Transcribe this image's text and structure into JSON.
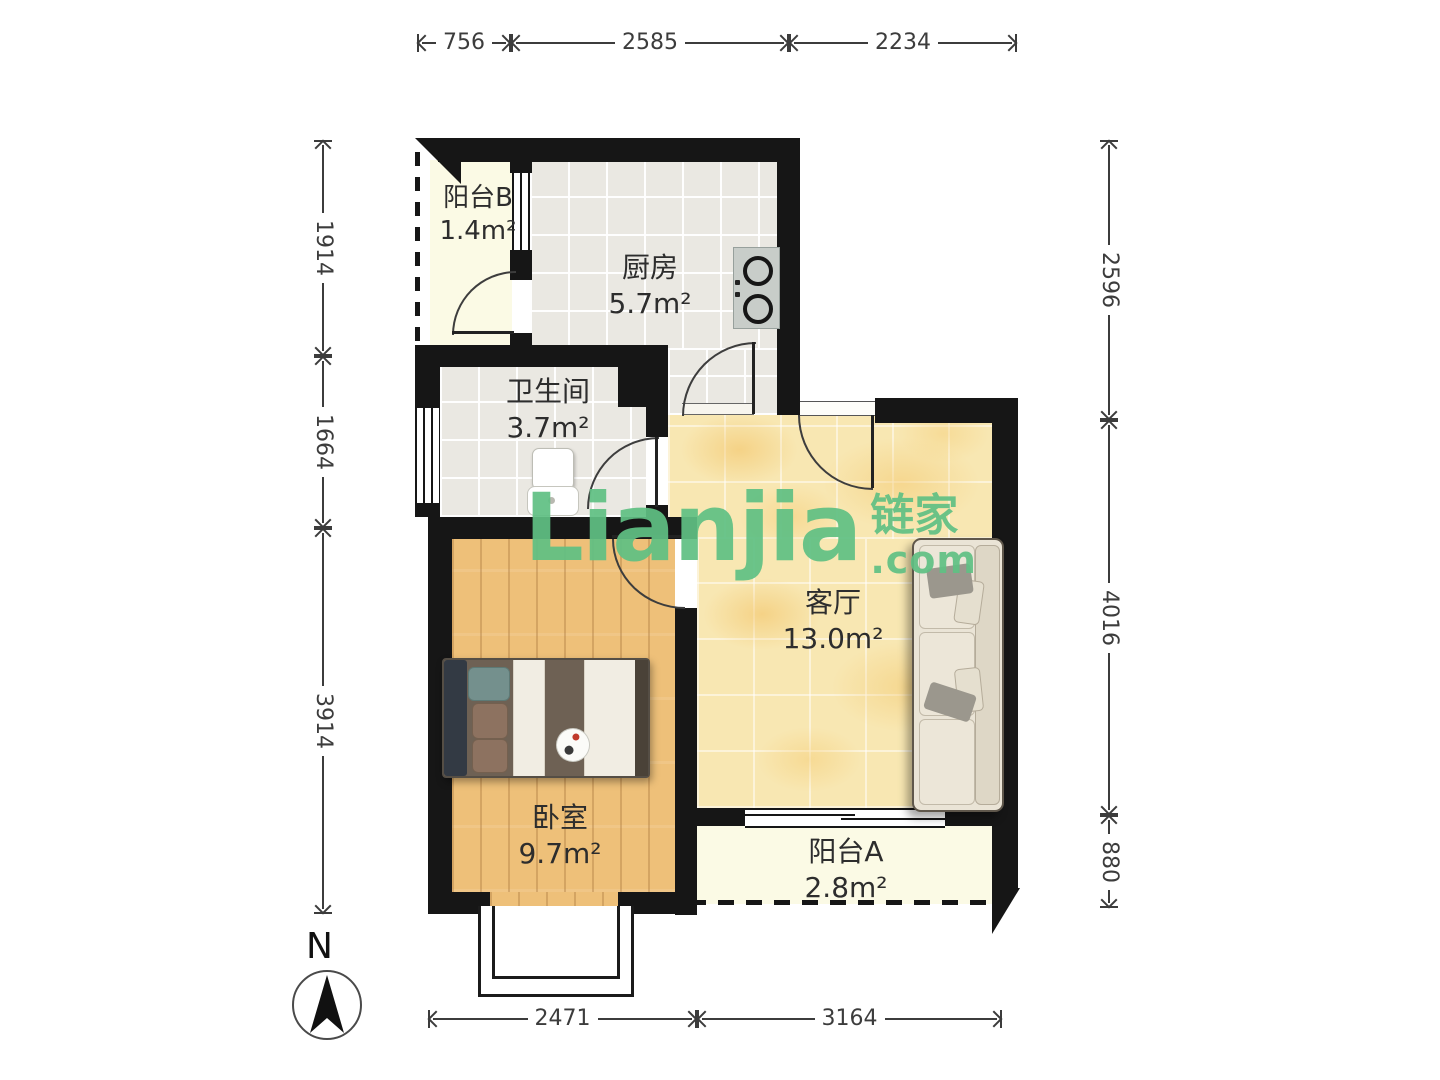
{
  "plan": {
    "rooms": [
      {
        "key": "balcony-b",
        "name": "阳台B",
        "area": "1.4m²"
      },
      {
        "key": "kitchen",
        "name": "厨房",
        "area": "5.7m²"
      },
      {
        "key": "bathroom",
        "name": "卫生间",
        "area": "3.7m²"
      },
      {
        "key": "living-room",
        "name": "客厅",
        "area": "13.0m²"
      },
      {
        "key": "bedroom",
        "name": "卧室",
        "area": "9.7m²"
      },
      {
        "key": "balcony-a",
        "name": "阳台A",
        "area": "2.8m²"
      }
    ],
    "dimensions_mm": {
      "top": [
        "756",
        "2585",
        "2234"
      ],
      "left": [
        "1914",
        "1664",
        "3914"
      ],
      "right": [
        "2596",
        "4016",
        "880"
      ],
      "bottom": [
        "2471",
        "3164"
      ]
    },
    "compass_label": "N",
    "watermark": {
      "brand": "Lianjia",
      "brand_cn": "链家",
      "suffix": ".com",
      "accent_color": "#5ec184"
    }
  }
}
